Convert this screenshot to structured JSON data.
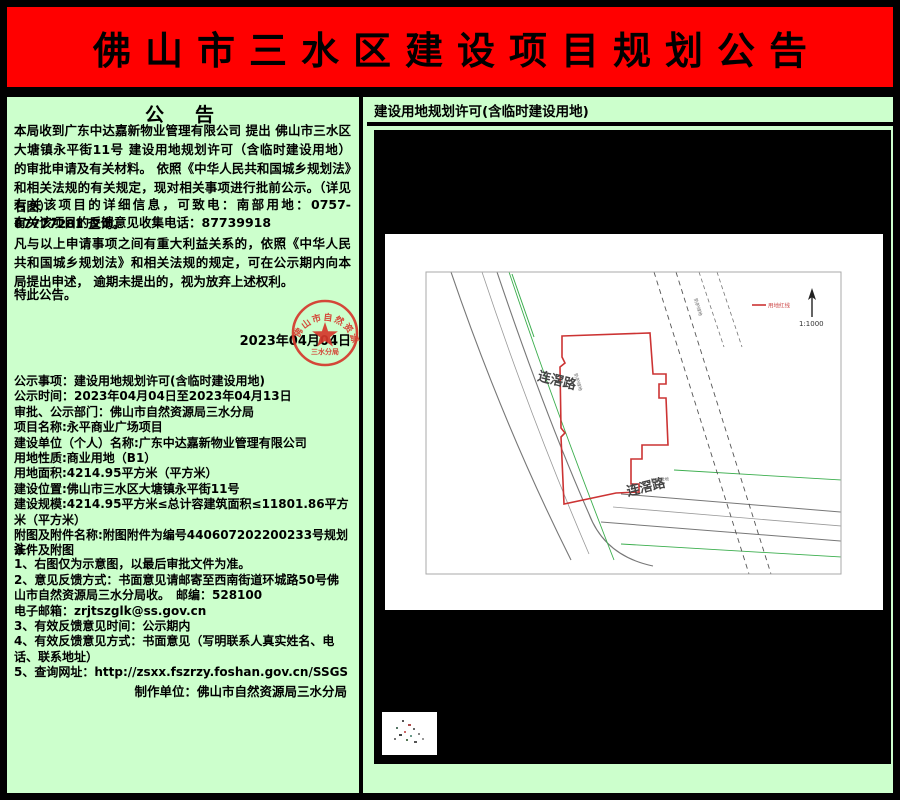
{
  "banner": {
    "title": "佛山市三水区建设项目规划公告",
    "bg_color": "#ff0000"
  },
  "page": {
    "bg_color": "#ccffcc",
    "border_color": "#000000"
  },
  "notice": {
    "heading": "公　告",
    "para1": "本局收到广东中达嘉新物业管理有限公司 提出 佛山市三水区大塘镇永平街11号 建设用地规划许可（含临时建设用地） 的审批申请及有关材料。 依照《中华人民共和国城乡规划法》和相关法规的有关规定，现对相关事项进行批前公示。（详见右图）",
    "para2": "有关该项目的详细信息，可致电：南部用地：0757-87777281 查询。",
    "para3": "有关该项目的反馈意见收集电话：87739918",
    "para4": "凡与以上申请事项之间有重大利益关系的，依照《中华人民共和国城乡规划法》和相关法规的规定，可在公示期内向本局提出申述， 逾期未提出的，视为放弃上述权利。",
    "para5": "特此公告。",
    "date": "2023年04月04日",
    "seal_arc_text": "佛山市自然资源局",
    "seal_sub_text": "三水分局",
    "details": [
      "公示事项：建设用地规划许可(含临时建设用地)",
      "公示时间：2023年04月04日至2023年04月13日",
      "审批、公示部门：佛山市自然资源局三水分局",
      "项目名称:永平商业广场项目",
      "建设单位（个人）名称:广东中达嘉新物业管理有限公司",
      "用地性质:商业用地（B1）",
      "用地面积:4214.95平方米（平方米）",
      "建设位置:佛山市三水区大塘镇永平街11号",
      "建设规模:4214.95平方米≤总计容建筑面积≤11801.86平方米（平方米）",
      "附图及附件名称:附图附件为编号440607202200233号规划条件及附图"
    ],
    "notes": [
      "注：",
      "1、右图仅为示意图，以最后审批文件为准。",
      "2、意见反馈方式：书面意见请邮寄至西南街道环城路50号佛山市自然资源局三水分局收。　邮编：528100",
      "电子邮箱：zrjtszglk@ss.gov.cn",
      "3、有效反馈意见时间：公示期内",
      "4、有效反馈意见方式：书面意见（写明联系人真实姓名、电话、联系地址）",
      "5、查询网址：http://zsxx.fszrzy.foshan.gov.cn/SSGS"
    ],
    "producer": "制作单位：佛山市自然资源局三水分局"
  },
  "permit": {
    "header": "建设用地规划许可(含临时建设用地)",
    "map": {
      "road_left_label": "连滘路",
      "road_bottom_label": "连滘路",
      "legend_label": "用地红线",
      "belt_label": "防护绿地",
      "scale_label": "1:1000",
      "boundary_color": "#cc3333"
    }
  }
}
